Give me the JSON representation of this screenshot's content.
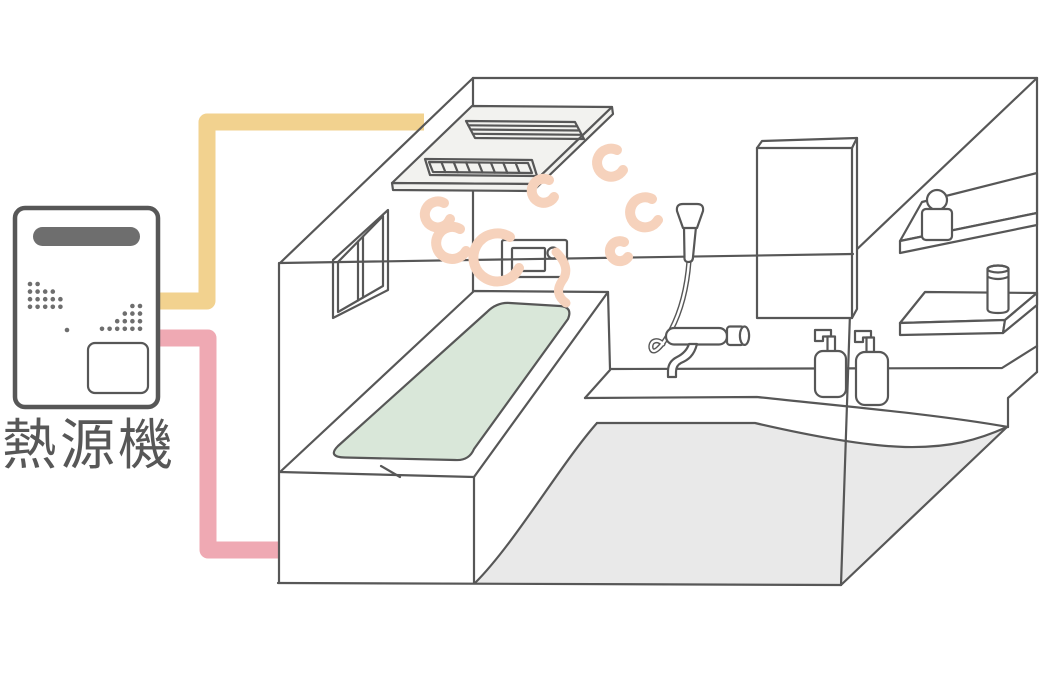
{
  "diagram": {
    "heat_source_label": "熱源機",
    "colors": {
      "background": "#ffffff",
      "line": "#575757",
      "hot_pipe": "#f2d28f",
      "bath_pipe": "#efa9b3",
      "steam": "#f6d2bc",
      "bath_water": "#d9e7d9",
      "floor": "#e9e9e9",
      "slab_fill": "#f2f2ef",
      "appliance_gray": "#6e6e6e",
      "label_color": "#575757"
    }
  }
}
